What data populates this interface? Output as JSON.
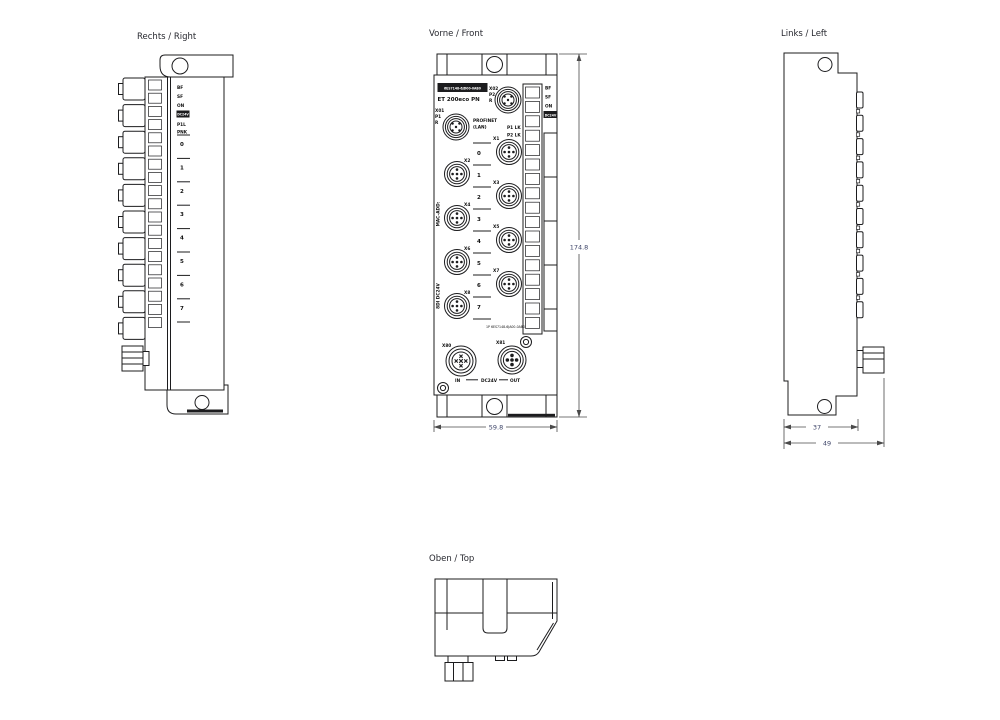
{
  "colors": {
    "line": "#1c1c1e",
    "text": "#26272e",
    "dim": "#3d4468",
    "dim_line": "#4a4a4a"
  },
  "titles": {
    "right": "Rechts / Right",
    "front": "Vorne / Front",
    "left": "Links / Left",
    "top": "Oben / Top"
  },
  "dims": {
    "height": "174.8",
    "width": "59.8",
    "depth_inner": "37",
    "depth_outer": "49"
  },
  "front": {
    "article_number": "6ES7148-6JD00-0AB0",
    "product_name": "ET 200eco PN",
    "profinet_label": "PROFINET",
    "profinet_sub": "(LAN)",
    "port1": {
      "id": "X01",
      "line2": "P1",
      "line3": "R"
    },
    "port2": {
      "id": "X02",
      "line2": "P2",
      "line3": "R"
    },
    "p1_link": "P1 LK",
    "p2_link": "P2 LK",
    "led_labels": [
      "BF",
      "SF",
      "ON",
      "DC24V"
    ],
    "ports": [
      "X1",
      "X2",
      "X3",
      "X4",
      "X5",
      "X6",
      "X7",
      "X8"
    ],
    "channels": [
      "0",
      "1",
      "2",
      "3",
      "4",
      "5",
      "6",
      "7"
    ],
    "mac_label": "MAC-ADD:",
    "io_label": "8DI DC24V",
    "order_number": "1P 6ES7148-6JA00-0AB0",
    "power": {
      "in_port": "X80",
      "out_port": "X81",
      "in": "IN",
      "bus": "DC24V",
      "out": "OUT"
    }
  },
  "right_view": {
    "led_labels": [
      "BF",
      "SF",
      "ON",
      "DC24V"
    ],
    "link_label_1": "P1L",
    "link_label_2": "PNK",
    "channels": [
      "0",
      "1",
      "2",
      "3",
      "4",
      "5",
      "6",
      "7"
    ]
  }
}
